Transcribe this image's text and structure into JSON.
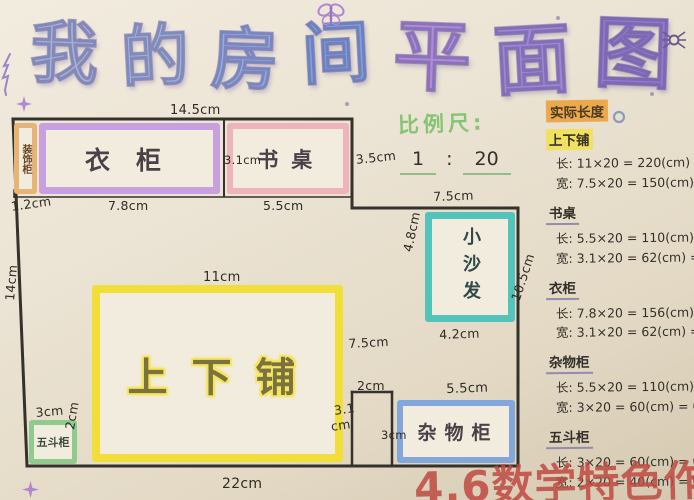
{
  "meta": {
    "paper_color": "#ebe3d3",
    "wall_color": "#35322c",
    "ink_color": "#2f2c27"
  },
  "title": {
    "text": "我的房间平面图",
    "char_colors": [
      "#a3b3d6",
      "#9fb6da",
      "#92aede",
      "#7ea3dc",
      "#b18bd8",
      "#a186d2",
      "#9678cc"
    ]
  },
  "scale_note": {
    "label": "比例尺:",
    "numerator": "1",
    "colon": ":",
    "denominator": "20",
    "label_color": "#85c473",
    "underline_color": "#8fc182"
  },
  "floor_plan": {
    "walls": [
      {
        "x1": 13,
        "y1": 119,
        "x2": 352,
        "y2": 119,
        "w": 3
      },
      {
        "x1": 13,
        "y1": 119,
        "x2": 27,
        "y2": 466,
        "w": 3
      },
      {
        "x1": 352,
        "y1": 119,
        "x2": 352,
        "y2": 208,
        "w": 3
      },
      {
        "x1": 352,
        "y1": 208,
        "x2": 518,
        "y2": 208,
        "w": 3
      },
      {
        "x1": 518,
        "y1": 208,
        "x2": 518,
        "y2": 466,
        "w": 3
      },
      {
        "x1": 27,
        "y1": 466,
        "x2": 518,
        "y2": 466,
        "w": 3
      },
      {
        "x1": 14,
        "y1": 197,
        "x2": 352,
        "y2": 197,
        "w": 1.5
      },
      {
        "x1": 14,
        "y1": 190,
        "x2": 14,
        "y2": 197,
        "w": 1.5
      },
      {
        "x1": 224,
        "y1": 121,
        "x2": 224,
        "y2": 196,
        "w": 2
      },
      {
        "x1": 352,
        "y1": 392,
        "x2": 392,
        "y2": 392,
        "w": 2.5
      },
      {
        "x1": 352,
        "y1": 392,
        "x2": 352,
        "y2": 465,
        "w": 2.5
      },
      {
        "x1": 392,
        "y1": 392,
        "x2": 392,
        "y2": 465,
        "w": 2.5
      }
    ],
    "furniture": [
      {
        "id": "decor-cabinet",
        "label": "装饰柜",
        "border_color": "#e7b476",
        "bw": 5,
        "x": 14,
        "y": 123,
        "w": 23,
        "h": 71,
        "vertical": true,
        "font": 10,
        "label_color": "#6b4420"
      },
      {
        "id": "wardrobe",
        "label": "衣柜",
        "border_color": "#c7a0dd",
        "bw": 7,
        "x": 39,
        "y": 123,
        "w": 181,
        "h": 71,
        "font": 25,
        "ls": 26
      },
      {
        "id": "desk",
        "label": "书桌",
        "border_color": "#efb3bb",
        "bw": 6,
        "x": 227,
        "y": 123,
        "w": 122,
        "h": 71,
        "font": 21,
        "ls": 13
      },
      {
        "id": "sofa",
        "label": "小沙发",
        "border_color": "#54c3bb",
        "bw": 7,
        "x": 425,
        "y": 212,
        "w": 90,
        "h": 110,
        "vertical": true,
        "font": 18,
        "ls": 9,
        "label_color": "#2f4a48"
      },
      {
        "id": "bunk-bed",
        "label": "上下铺",
        "border_color": "#f1de39",
        "bw": 8,
        "x": 92,
        "y": 285,
        "w": 251,
        "h": 177,
        "font": 40,
        "ls": 24,
        "highlight": true
      },
      {
        "id": "chest",
        "label": "五斗柜",
        "border_color": "#8ecb8c",
        "bw": 5,
        "x": 29,
        "y": 420,
        "w": 48,
        "h": 44,
        "font": 11,
        "label_color": "#3f4a3a"
      },
      {
        "id": "storage",
        "label": "杂物柜",
        "border_color": "#83a7da",
        "bw": 6,
        "x": 397,
        "y": 400,
        "w": 118,
        "h": 63,
        "font": 19,
        "ls": 8
      }
    ],
    "dimension_labels": [
      {
        "t": "14.5cm",
        "x": 170,
        "y": 103,
        "s": 13
      },
      {
        "t": "1.2cm",
        "x": 10,
        "y": 199,
        "r": -8
      },
      {
        "t": "7.8cm",
        "x": 108,
        "y": 198
      },
      {
        "t": "3.1cm",
        "x": 224,
        "y": 153,
        "s": 11.5
      },
      {
        "t": "5.5cm",
        "x": 263,
        "y": 198
      },
      {
        "t": "3.5cm",
        "x": 355,
        "y": 152,
        "r": -6
      },
      {
        "t": "7.5cm",
        "x": 433,
        "y": 189,
        "r": -2
      },
      {
        "t": "4.8cm",
        "x": 400,
        "y": 250,
        "r": -78
      },
      {
        "t": "4.2cm",
        "x": 439,
        "y": 327,
        "r": -2
      },
      {
        "t": "10.5cm",
        "x": 508,
        "y": 298,
        "r": -72
      },
      {
        "t": "11cm",
        "x": 203,
        "y": 270,
        "s": 13
      },
      {
        "t": "7.5cm",
        "x": 348,
        "y": 336,
        "r": -3
      },
      {
        "t": "3.1",
        "x": 333,
        "y": 403,
        "r": -8
      },
      {
        "t": "cm",
        "x": 330,
        "y": 419,
        "r": -8
      },
      {
        "t": "2cm",
        "x": 357,
        "y": 378
      },
      {
        "t": "5.5cm",
        "x": 446,
        "y": 382,
        "s": 13,
        "r": -2
      },
      {
        "t": "3cm",
        "x": 381,
        "y": 428,
        "s": 11.5
      },
      {
        "t": "3cm",
        "x": 35,
        "y": 405,
        "r": -5
      },
      {
        "t": "2cm",
        "x": 62,
        "y": 428,
        "r": -80
      },
      {
        "t": "22cm",
        "x": 222,
        "y": 476,
        "s": 14
      },
      {
        "t": "14cm",
        "x": 2,
        "y": 300,
        "r": -85
      }
    ]
  },
  "calculations": {
    "header": {
      "text": "实际长度",
      "highlight": "#eba94e"
    },
    "sections": [
      {
        "title": "上下铺",
        "highlight": "#f2e060",
        "lines": [
          "长: 11×20 = 220(cm) = 2.2m",
          "宽: 7.5×20 = 150(cm) = 1.5m"
        ]
      },
      {
        "title": "书桌",
        "lines": [
          "长: 5.5×20 = 110(cm) = 1.1m",
          "宽: 3.1×20 = 62(cm) = 0.62m"
        ]
      },
      {
        "title": "衣柜",
        "lines": [
          "长: 7.8×20 = 156(cm) = 1.56m",
          "宽: 3.1×20 = 62(cm) = 0.62m"
        ]
      },
      {
        "title": "杂物柜",
        "lines": [
          "长: 5.5×20 = 110(cm) = 1.1m",
          "宽: 3×20 = 60(cm) = 0.6m"
        ]
      },
      {
        "title": "五斗柜",
        "lines": [
          "长: 3×20 = 60(cm) = 0.6m",
          "宽: 2×20 = 40(cm) = 0.4m"
        ]
      }
    ]
  },
  "stamp": {
    "text": "4.6数学特色作业",
    "color": "#bf4a42"
  },
  "decorations": [
    "butterfly-doodle",
    "tree-doodle",
    "spider-doodle",
    "sparkle-doodle",
    "star-doodle",
    "circle-doodle",
    "ink-dots"
  ]
}
